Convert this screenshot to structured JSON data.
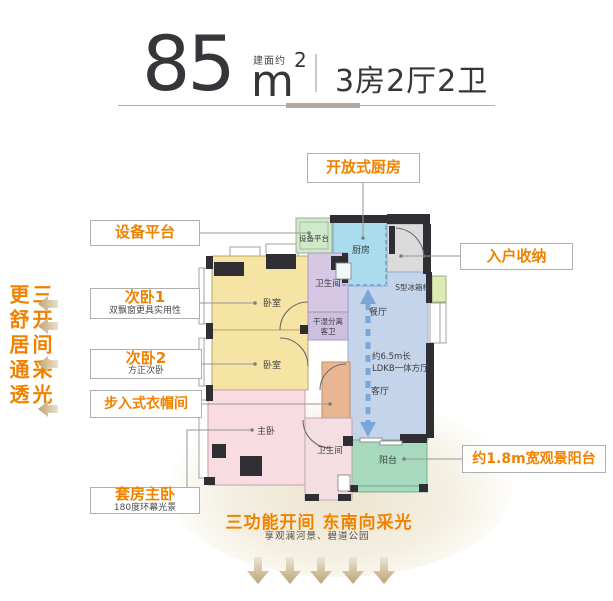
{
  "header": {
    "area_value": "85",
    "area_prefix": "建面约",
    "area_unit": "m",
    "area_sup": "2",
    "layout": "3房2厅2卫"
  },
  "tagline": {
    "col1": "三开间采光",
    "col2": "更舒居通透"
  },
  "callouts": {
    "equipment_platform": {
      "title": "设备平台"
    },
    "bedroom1": {
      "title": "次卧1",
      "subtitle": "双飘窗更具实用性"
    },
    "bedroom2": {
      "title": "次卧2",
      "subtitle": "方正次卧"
    },
    "walkin_closet": {
      "title": "步入式衣帽间"
    },
    "master_suite": {
      "title": "套房主卧",
      "subtitle": "180度环幕光景"
    },
    "open_kitchen": {
      "title": "开放式厨房"
    },
    "entry_storage": {
      "title": "入户收纳"
    },
    "view_balcony": {
      "title": "约1.8m宽观景阳台"
    }
  },
  "plan": {
    "equipment_platform": "设备平台",
    "kitchen": "厨房",
    "fridge_cabinet": "S型冰箱柜",
    "dining": "餐厅",
    "ldk1": "约6.5m长",
    "ldk2": "LDKB一体方厅",
    "living": "客厅",
    "bedroom1": "卧室",
    "bedroom2": "卧室",
    "bath1": "卫生间",
    "guest_bath1": "干湿分离",
    "guest_bath2": "客卫",
    "master": "主卧",
    "bath2": "卫生间",
    "balcony": "阳台"
  },
  "footer": {
    "headline": "三功能开间 东南向采光",
    "subline": "享观澜河景、碧道公园"
  },
  "colors": {
    "accent_orange": "#F08200",
    "arrow_tan": "#C9B289",
    "arrow_blue": "#7AA6DA",
    "wall_dark": "#2F2F33"
  }
}
